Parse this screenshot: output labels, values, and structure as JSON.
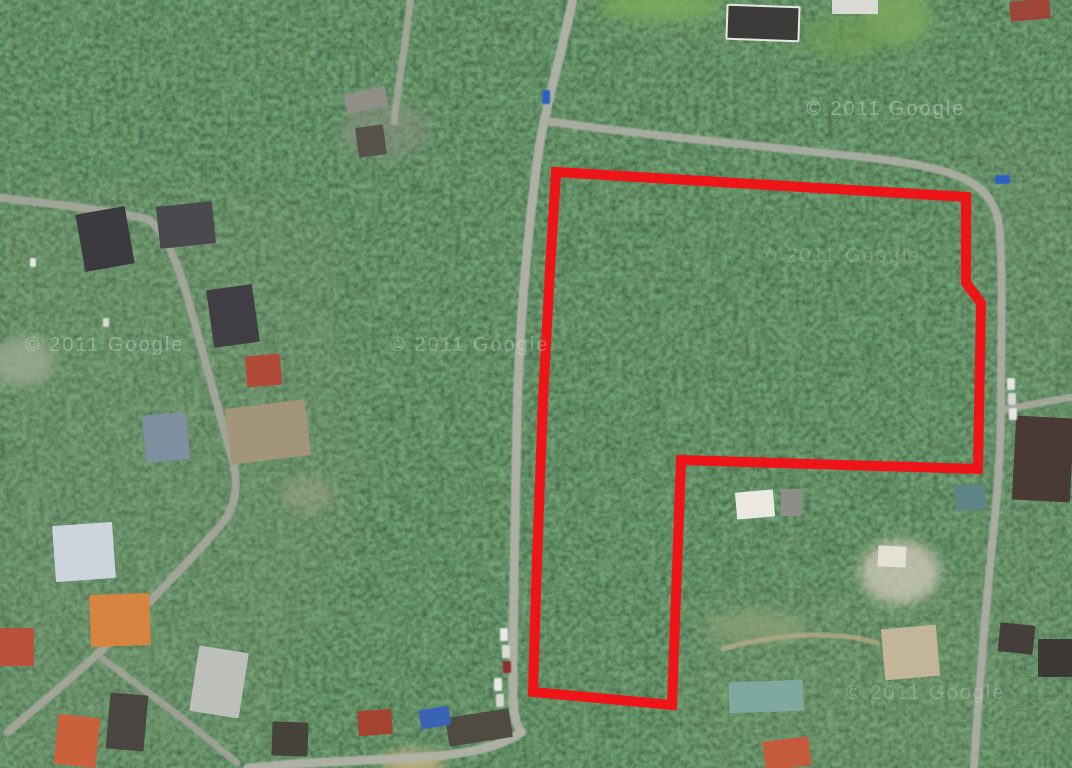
{
  "map": {
    "description": "Satellite aerial view of a forested suburban area with a land parcel outlined in red",
    "canvas": {
      "width": 1072,
      "height": 768
    },
    "colors": {
      "forest_base": "#24321e",
      "road": "#b2b2a8",
      "dirt_road": "#b9aa86",
      "parcel_outline": "#ee1418",
      "watermark": "#ffffff"
    },
    "watermark": {
      "text": "© 2011 Google",
      "font_size": 20,
      "instances": [
        {
          "x": 25,
          "y": 351,
          "opacity": 0.3
        },
        {
          "x": 390,
          "y": 351,
          "opacity": 0.26
        },
        {
          "x": 806,
          "y": 115,
          "opacity": 0.3
        },
        {
          "x": 762,
          "y": 262,
          "opacity": 0.16
        },
        {
          "x": 846,
          "y": 699,
          "opacity": 0.2
        }
      ]
    },
    "parcel": {
      "stroke_width": 10,
      "color": "#ee1418",
      "points": [
        [
          556,
          172
        ],
        [
          966,
          197
        ],
        [
          966,
          283
        ],
        [
          981,
          303
        ],
        [
          978,
          469
        ],
        [
          681,
          460
        ],
        [
          672,
          705
        ],
        [
          533,
          692
        ],
        [
          537,
          560
        ],
        [
          543,
          400
        ],
        [
          550,
          270
        ]
      ]
    },
    "roads": [
      {
        "name": "main-road-north-south",
        "d": "M574,-6 C558,70 543,112 536,170 C526,250 519,330 517,420 C515,520 513,610 513,688 C513,710 515,724 521,732",
        "w": 9,
        "color": "#b2b2a8",
        "o": 0.95
      },
      {
        "name": "bottom-road",
        "d": "M521,732 C498,750 452,756 408,758 C350,761 295,763 248,768",
        "w": 9,
        "color": "#b2b2a8",
        "o": 0.95
      },
      {
        "name": "top-branch-road",
        "d": "M411,-5 C406,40 399,80 394,122",
        "w": 7,
        "color": "#a8a89e",
        "o": 0.9
      },
      {
        "name": "east-road",
        "d": "M546,121 C630,133 710,141 806,151 C864,157 922,162 958,176 C986,187 998,206 1000,232 C1003,282 1001,340 1001,400 C1001,452 997,502 991,555 C986,612 979,680 974,768",
        "w": 8,
        "color": "#aeaea4",
        "o": 0.92
      },
      {
        "name": "east-branch-road",
        "d": "M1002,410 L1072,397",
        "w": 7,
        "color": "#aaaaa0",
        "o": 0.9
      },
      {
        "name": "west-road",
        "d": "M-6,197 C45,203 102,209 148,219 C166,231 179,268 189,302 C201,346 219,412 233,462 C239,486 235,509 221,525 C190,560 151,601 111,641 C81,671 42,702 8,732",
        "w": 8,
        "color": "#a8a89e",
        "o": 0.9
      },
      {
        "name": "southwest-branch-road",
        "d": "M96,654 C132,681 182,716 237,763",
        "w": 7,
        "color": "#a4a49a",
        "o": 0.85
      },
      {
        "name": "dirt-driveway",
        "d": "M723,649 C770,635 830,629 877,643",
        "w": 5,
        "color": "#b9aa86",
        "o": 0.75
      }
    ],
    "buildings": [
      {
        "x": 345,
        "y": 90,
        "w": 42,
        "h": 20,
        "r": -12,
        "c": "#8f8f87"
      },
      {
        "x": 357,
        "y": 126,
        "w": 28,
        "h": 30,
        "r": -8,
        "c": "#575249"
      },
      {
        "x": 80,
        "y": 210,
        "w": 50,
        "h": 58,
        "r": -10,
        "c": "#3b3b3f"
      },
      {
        "x": 158,
        "y": 204,
        "w": 56,
        "h": 42,
        "r": -6,
        "c": "#4a4a4e"
      },
      {
        "x": 210,
        "y": 287,
        "w": 46,
        "h": 58,
        "r": -8,
        "c": "#403e44"
      },
      {
        "x": 246,
        "y": 355,
        "w": 35,
        "h": 31,
        "r": -5,
        "c": "#b24a38"
      },
      {
        "x": 144,
        "y": 414,
        "w": 44,
        "h": 47,
        "r": -5,
        "c": "#7e90a0"
      },
      {
        "x": 228,
        "y": 404,
        "w": 80,
        "h": 56,
        "r": -7,
        "c": "#a39579"
      },
      {
        "x": 54,
        "y": 524,
        "w": 60,
        "h": 56,
        "r": -4,
        "c": "#ccd5de"
      },
      {
        "x": 90,
        "y": 594,
        "w": 60,
        "h": 52,
        "r": -2,
        "c": "#d78440"
      },
      {
        "x": 0,
        "y": 628,
        "w": 34,
        "h": 38,
        "r": 0,
        "c": "#bd4f3d"
      },
      {
        "x": 56,
        "y": 716,
        "w": 42,
        "h": 50,
        "r": 6,
        "c": "#cb603c"
      },
      {
        "x": 108,
        "y": 694,
        "w": 38,
        "h": 56,
        "r": 5,
        "c": "#494540"
      },
      {
        "x": 194,
        "y": 649,
        "w": 50,
        "h": 66,
        "r": 9,
        "c": "#bdc0ba"
      },
      {
        "x": 272,
        "y": 722,
        "w": 36,
        "h": 34,
        "r": 2,
        "c": "#46433d"
      },
      {
        "x": 358,
        "y": 710,
        "w": 34,
        "h": 25,
        "r": -4,
        "c": "#a34330"
      },
      {
        "x": 447,
        "y": 713,
        "w": 64,
        "h": 29,
        "r": -9,
        "c": "#4f4b43"
      },
      {
        "x": 420,
        "y": 708,
        "w": 30,
        "h": 19,
        "r": -9,
        "c": "#3a63b5"
      },
      {
        "x": 727,
        "y": 6,
        "w": 72,
        "h": 34,
        "r": 2,
        "c": "#3d3b39",
        "s": "#e8e8e2"
      },
      {
        "x": 832,
        "y": 0,
        "w": 46,
        "h": 14,
        "r": 0,
        "c": "#dadad4"
      },
      {
        "x": 1010,
        "y": 0,
        "w": 40,
        "h": 20,
        "r": -5,
        "c": "#9c4538"
      },
      {
        "x": 1014,
        "y": 417,
        "w": 58,
        "h": 84,
        "r": 3,
        "c": "#4a3a35"
      },
      {
        "x": 883,
        "y": 627,
        "w": 55,
        "h": 51,
        "r": -5,
        "c": "#c3b59a"
      },
      {
        "x": 729,
        "y": 681,
        "w": 74,
        "h": 31,
        "r": -2,
        "c": "#7fa8a0"
      },
      {
        "x": 764,
        "y": 739,
        "w": 46,
        "h": 29,
        "r": -7,
        "c": "#c55a3c"
      },
      {
        "x": 736,
        "y": 491,
        "w": 38,
        "h": 27,
        "r": -5,
        "c": "#eae8e1"
      },
      {
        "x": 781,
        "y": 489,
        "w": 21,
        "h": 27,
        "r": 0,
        "c": "#8e8e88"
      },
      {
        "x": 955,
        "y": 485,
        "w": 31,
        "h": 25,
        "r": -4,
        "c": "#5f8486"
      },
      {
        "x": 878,
        "y": 546,
        "w": 28,
        "h": 21,
        "r": 3,
        "c": "#e4e0d4"
      },
      {
        "x": 999,
        "y": 624,
        "w": 35,
        "h": 29,
        "r": 6,
        "c": "#443f3a"
      },
      {
        "x": 1038,
        "y": 639,
        "w": 34,
        "h": 38,
        "r": 0,
        "c": "#3d3935"
      }
    ],
    "cars": [
      {
        "x": 542,
        "y": 90,
        "w": 8,
        "h": 14,
        "c": "#2f5fc2"
      },
      {
        "x": 995,
        "y": 175,
        "w": 15,
        "h": 9,
        "c": "#2f5fc2"
      },
      {
        "x": 500,
        "y": 628,
        "w": 8,
        "h": 13,
        "c": "#e8e8e4"
      },
      {
        "x": 502,
        "y": 645,
        "w": 8,
        "h": 13,
        "c": "#dcdcd6"
      },
      {
        "x": 503,
        "y": 661,
        "w": 8,
        "h": 12,
        "c": "#8c2f2f"
      },
      {
        "x": 494,
        "y": 678,
        "w": 8,
        "h": 13,
        "c": "#e8e8e4"
      },
      {
        "x": 496,
        "y": 694,
        "w": 8,
        "h": 13,
        "c": "#d8d8d2"
      },
      {
        "x": 1007,
        "y": 378,
        "w": 8,
        "h": 12,
        "c": "#e6e6e0"
      },
      {
        "x": 1008,
        "y": 393,
        "w": 8,
        "h": 12,
        "c": "#dadad4"
      },
      {
        "x": 1009,
        "y": 408,
        "w": 8,
        "h": 12,
        "c": "#e6e6e0"
      },
      {
        "x": 30,
        "y": 258,
        "w": 6,
        "h": 9,
        "c": "#e8e8e4"
      },
      {
        "x": 103,
        "y": 318,
        "w": 6,
        "h": 9,
        "c": "#dcdcd6"
      }
    ],
    "clearings": [
      {
        "cx": 22,
        "cy": 362,
        "rx": 32,
        "ry": 24,
        "c": "#9aa98f",
        "o": 0.85
      },
      {
        "cx": 660,
        "cy": 7,
        "rx": 62,
        "ry": 13,
        "c": "#7cab5e",
        "o": 0.9
      },
      {
        "cx": 897,
        "cy": 18,
        "rx": 34,
        "ry": 26,
        "c": "#7cab5e",
        "o": 0.8
      },
      {
        "cx": 845,
        "cy": 38,
        "rx": 42,
        "ry": 22,
        "c": "#6f9e55",
        "o": 0.6
      },
      {
        "cx": 413,
        "cy": 762,
        "rx": 32,
        "ry": 11,
        "c": "#c9b483",
        "o": 0.9
      },
      {
        "cx": 900,
        "cy": 572,
        "rx": 40,
        "ry": 32,
        "c": "#cfc8b6",
        "o": 0.8
      },
      {
        "cx": 307,
        "cy": 495,
        "rx": 28,
        "ry": 18,
        "c": "#a3a18c",
        "o": 0.5
      },
      {
        "cx": 757,
        "cy": 627,
        "rx": 52,
        "ry": 16,
        "c": "#8da077",
        "o": 0.7
      },
      {
        "cx": 385,
        "cy": 130,
        "rx": 45,
        "ry": 28,
        "c": "#8f9184",
        "o": 0.5
      }
    ],
    "washes": [
      {
        "d": "M0,185 L320,205 L360,480 L250,768 L0,768 Z",
        "c": "#8e987e",
        "o": 0.16
      },
      {
        "d": "M950,140 L1072,130 L1072,768 L940,768 L980,420 Z",
        "c": "#8e987e",
        "o": 0.1
      },
      {
        "d": "M600,0 L960,0 L940,60 L620,40 Z",
        "c": "#7fa35e",
        "o": 0.12
      },
      {
        "d": "M690,600 L980,590 L980,768 L690,768 Z",
        "c": "#96a07e",
        "o": 0.12
      }
    ]
  }
}
